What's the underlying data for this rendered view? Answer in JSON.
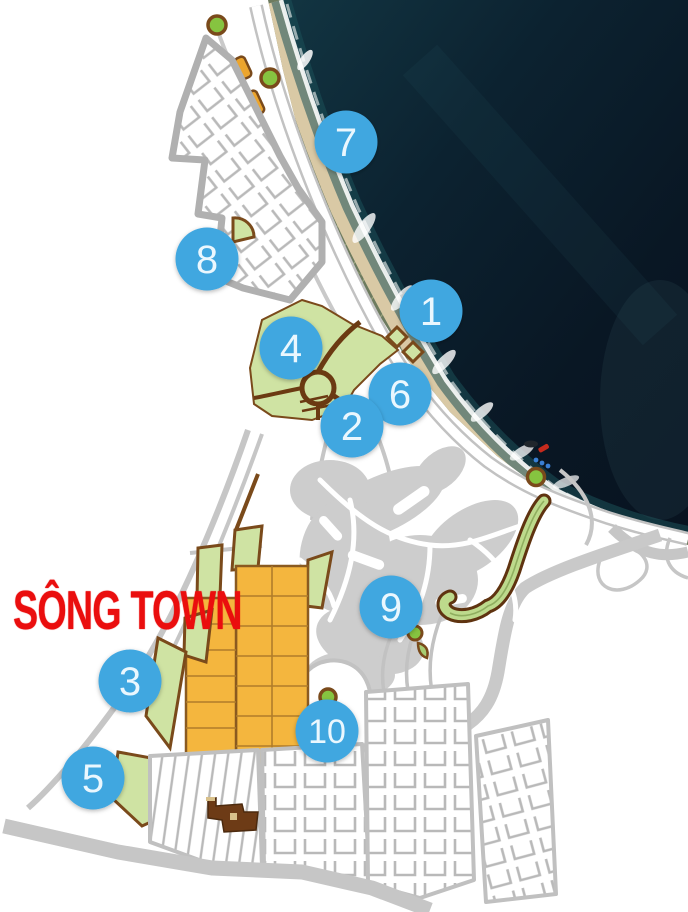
{
  "map": {
    "town_label": "SÔNG TOWN"
  },
  "markers": [
    {
      "label": "1"
    },
    {
      "label": "2"
    },
    {
      "label": "3"
    },
    {
      "label": "4"
    },
    {
      "label": "5"
    },
    {
      "label": "6"
    },
    {
      "label": "7"
    },
    {
      "label": "8"
    },
    {
      "label": "9"
    },
    {
      "label": "10"
    }
  ],
  "colors": {
    "marker_blue": "#41a7e0",
    "marker_number": "#eaf7fe",
    "label_red": "#ea0e0e",
    "ocean_deep": "#081320",
    "ocean_shore": "#1c5058",
    "foam_white": "#f4f7f5",
    "sand": "#d9c9a5",
    "vegetation": "#6d7b5f",
    "road_gray": "#c2c2c2",
    "golf_gray": "#cdcdcd",
    "park_green": "#cfe3a3",
    "roundabout_green": "#86c440",
    "outline_brown": "#7a4a1b",
    "lot_orange": "#eca52d",
    "block_orange": "#f4b63e",
    "building_brown": "#6d3b16"
  }
}
